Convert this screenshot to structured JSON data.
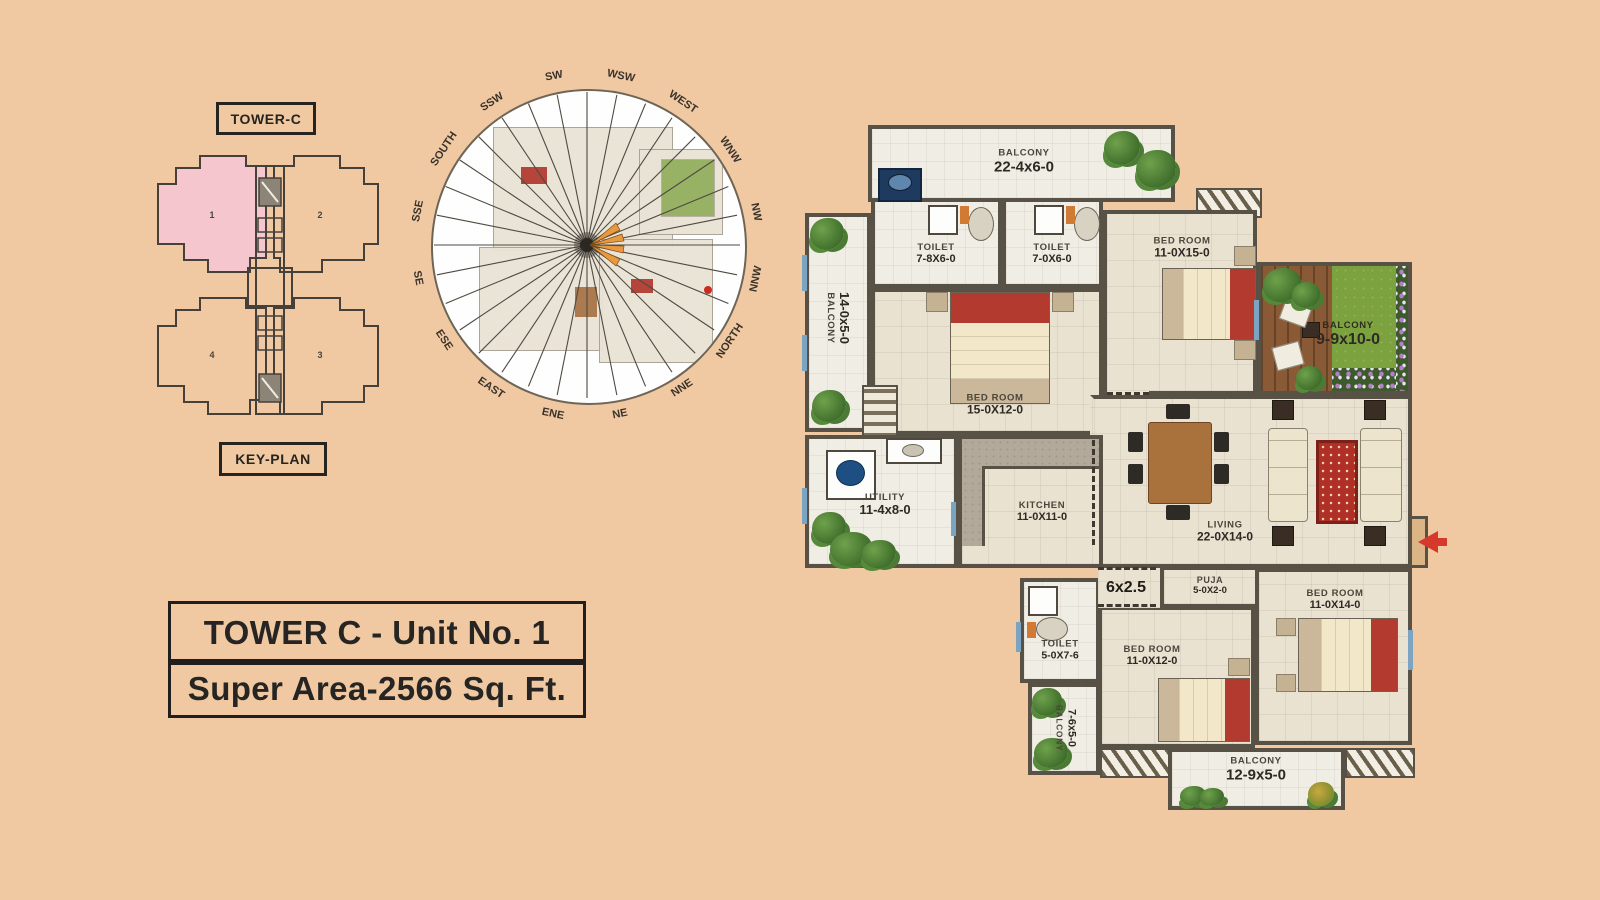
{
  "key_plan": {
    "tower_label": "TOWER-C",
    "plan_label": "KEY-PLAN",
    "unit_numbers": [
      "1",
      "2",
      "3",
      "4"
    ],
    "highlight_color": "#f5c6ce"
  },
  "compass": {
    "directions": [
      "SW",
      "WSW",
      "WEST",
      "WNW",
      "NW",
      "NNW",
      "NORTH",
      "NNE",
      "NE",
      "ENE",
      "EAST",
      "ESE",
      "SE",
      "SSE",
      "SOUTH",
      "SSW"
    ],
    "start_angle_deg": -11,
    "step_deg": 22.5
  },
  "title": {
    "line1": "TOWER C - Unit No. 1",
    "line2": "Super Area-2566 Sq. Ft."
  },
  "rooms": {
    "balcony_top": {
      "name": "BALCONY",
      "dim": "22-4x6-0"
    },
    "toilet_1": {
      "name": "TOILET",
      "dim": "7-8X6-0"
    },
    "toilet_2": {
      "name": "TOILET",
      "dim": "7-0X6-0"
    },
    "bedroom_top_right": {
      "name": "BED ROOM",
      "dim": "11-0X15-0"
    },
    "balcony_left": {
      "name": "BALCONY",
      "dim": "14-0x5-0"
    },
    "bedroom_mid": {
      "name": "BED ROOM",
      "dim": "15-0X12-0"
    },
    "balcony_green": {
      "name": "BALCONY",
      "dim": "9-9x10-0"
    },
    "living": {
      "name": "LIVING",
      "dim": "22-0X14-0"
    },
    "utility": {
      "name": "UTILITY",
      "dim": "11-4x8-0"
    },
    "kitchen": {
      "name": "KITCHEN",
      "dim": "11-0X11-0"
    },
    "passage": {
      "dim": "6x2.5"
    },
    "puja": {
      "name": "PUJA",
      "dim": "5-0X2-0"
    },
    "toilet_3": {
      "name": "TOILET",
      "dim": "5-0X7-6"
    },
    "bedroom_bot_mid": {
      "name": "BED ROOM",
      "dim": "11-0X12-0"
    },
    "bedroom_bot_right": {
      "name": "BED ROOM",
      "dim": "11-0X14-0"
    },
    "balcony_small": {
      "name": "BALCONY",
      "dim": "7-6x5-0"
    },
    "balcony_bottom": {
      "name": "BALCONY",
      "dim": "12-9x5-0"
    }
  },
  "colors": {
    "page_bg": "#f0c9a2",
    "wall": "#575146",
    "accent_red": "#b23a2e",
    "entry_arrow": "#d5392b",
    "grass": "#7ca23f",
    "deck_wood": "#8a5a36",
    "window_blue": "#7ba3c2"
  }
}
